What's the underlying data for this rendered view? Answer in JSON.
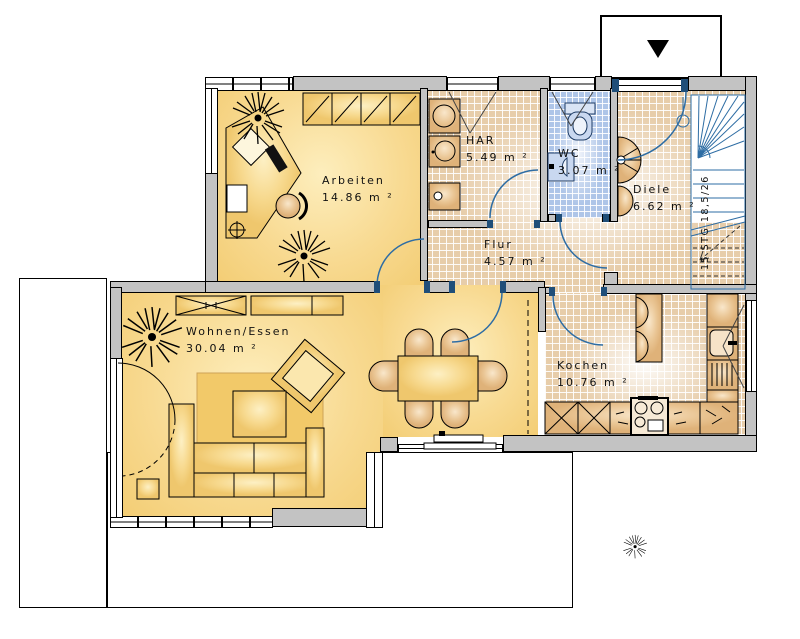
{
  "plan": {
    "type": "floorplan-ground-floor",
    "rooms": {
      "arbeiten": {
        "name": "Arbeiten",
        "area": "14.86 m ²"
      },
      "har": {
        "name": "HAR",
        "area": "5.49 m ²"
      },
      "wc": {
        "name": "WC",
        "area": "3.07 m ²"
      },
      "diele": {
        "name": "Diele",
        "area": "6.62 m ²"
      },
      "flur": {
        "name": "Flur",
        "area": "4.57 m ²"
      },
      "wohnen_essen": {
        "name": "Wohnen/Essen",
        "area": "30.04 m ²"
      },
      "kochen": {
        "name": "Kochen",
        "area": "10.76 m ²"
      }
    },
    "stairs": {
      "label": "15 STG 18,5/26"
    },
    "icons": {
      "entrance_arrow": "triangle-down"
    },
    "colors": {
      "wall_gray": "#c3c3c3",
      "floor_yellow": "#f7d78d",
      "tile_beige": "#e7cdaa",
      "tile_blue": "#aec5e8",
      "door_blue": "#2e6da4",
      "frame_navy": "#1f4e79",
      "terrace_stripe": "#5c2d55",
      "furniture_tan": "#e8c08b"
    }
  }
}
